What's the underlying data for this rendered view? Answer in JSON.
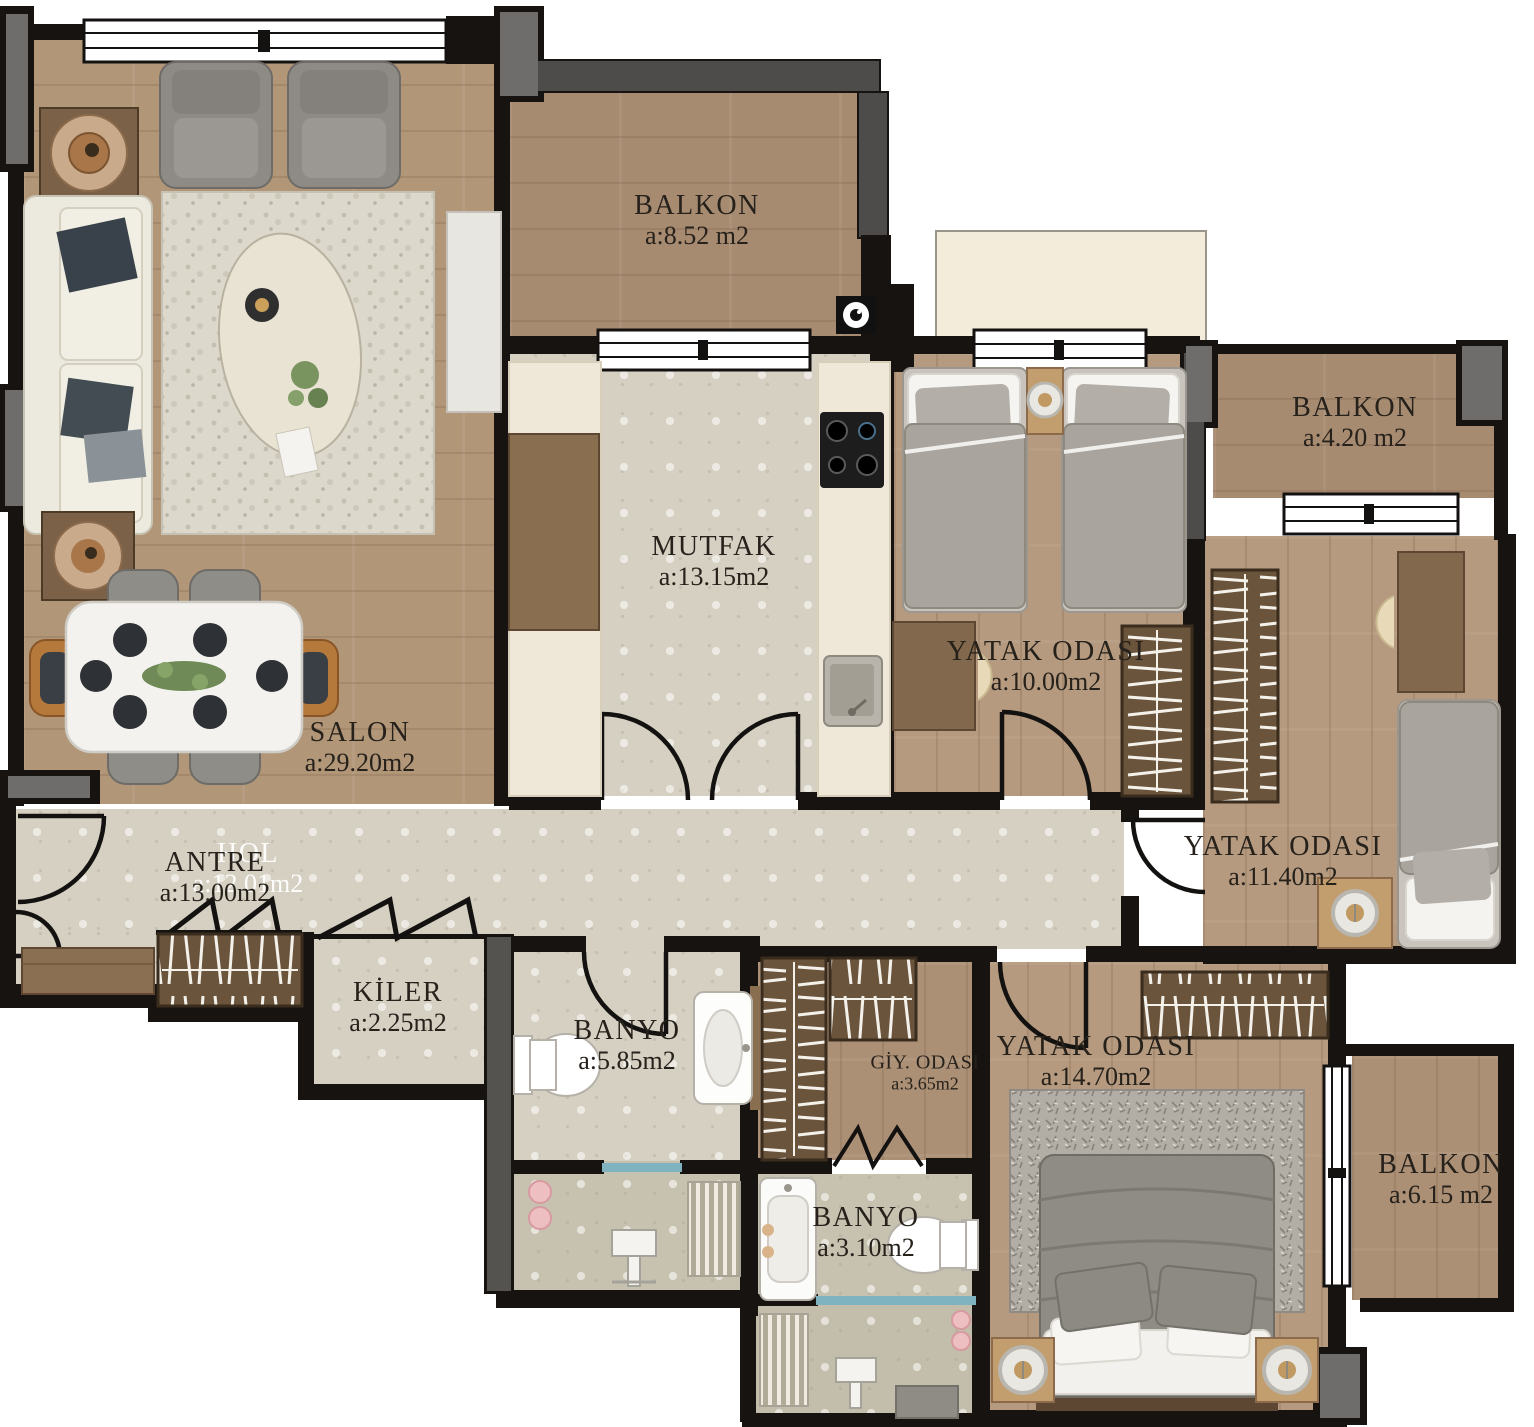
{
  "plan": {
    "type": "apartment-floor-plan",
    "rooms": [
      {
        "id": "salon",
        "name": "SALON",
        "area": "a:29.20m2"
      },
      {
        "id": "mutfak",
        "name": "MUTFAK",
        "area": "a:13.15m2"
      },
      {
        "id": "antre",
        "name": "ANTRE",
        "area": "a:13.00m2"
      },
      {
        "id": "kiler",
        "name": "KİLER",
        "area": "a:2.25m2"
      },
      {
        "id": "banyo-buyuk",
        "name": "BANYO",
        "area": "a:5.85m2"
      },
      {
        "id": "yatak-odasi-1",
        "name": "YATAK ODASI",
        "area": "a:10.00m2"
      },
      {
        "id": "yatak-odasi-2",
        "name": "YATAK ODASI",
        "area": "a:11.40m2"
      },
      {
        "id": "giyinme-odasi",
        "name": "GİY. ODASI",
        "area": "a:3.65m2"
      },
      {
        "id": "yatak-odasi-3",
        "name": "YATAK ODASI",
        "area": "a:14.70m2"
      },
      {
        "id": "banyo-kucuk",
        "name": "BANYO",
        "area": "a:3.10m2"
      },
      {
        "id": "balkon-ust",
        "name": "BALKON",
        "area": "a:8.52 m2"
      },
      {
        "id": "balkon-sag",
        "name": "BALKON",
        "area": "a:4.20 m2"
      },
      {
        "id": "balkon-alt",
        "name": "BALKON",
        "area": "a:6.15 m2"
      }
    ],
    "ghost_label": {
      "name": "HOL",
      "area": "a:12.01m2"
    },
    "colors": {
      "wall": "#161310",
      "charcoal_wall": "#4e4c4a",
      "pillar_gray": "#6f6d6b",
      "wood_floor": "#b19678",
      "marble_floor": "#d6d0c3",
      "shower_glass": "#7fb3bf",
      "counter_cream": "#efe8d8",
      "wardrobe_wood": "#6b543c",
      "accent_chair_orange": "#b5793c"
    }
  }
}
